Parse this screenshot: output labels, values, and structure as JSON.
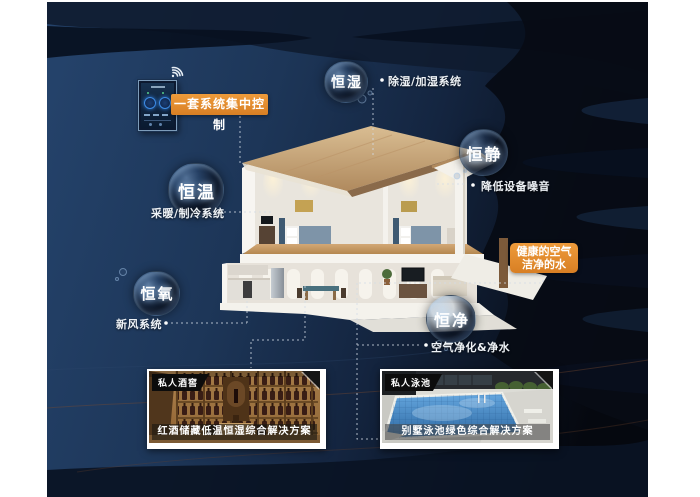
{
  "control_panel": {
    "label": "一套系统集中控制",
    "icon": "wifi-icon"
  },
  "systems": [
    {
      "id": "humidity",
      "bubble": "恒湿",
      "label": "除湿/加湿系统"
    },
    {
      "id": "quiet",
      "bubble": "恒静",
      "label": "降低设备噪音"
    },
    {
      "id": "temperature",
      "bubble": "恒温",
      "label": "采暖/制冷系统"
    },
    {
      "id": "oxygen",
      "bubble": "恒氧",
      "label": "新风系统"
    },
    {
      "id": "purity",
      "bubble": "恒净",
      "label": "空气净化&净水"
    }
  ],
  "highlight": {
    "line1": "健康的空气",
    "line2": "洁净的水"
  },
  "cards": [
    {
      "badge": "私人酒窖",
      "caption": "红酒储藏低温恒湿综合解决方案"
    },
    {
      "badge": "私人泳池",
      "caption": "别墅泳池绿色综合解决方案"
    }
  ],
  "colors": {
    "accent_orange": "#e08a2e",
    "background_navy": "#1c3454",
    "wave_dark": "#070d18",
    "text_light": "#eef2f6"
  }
}
